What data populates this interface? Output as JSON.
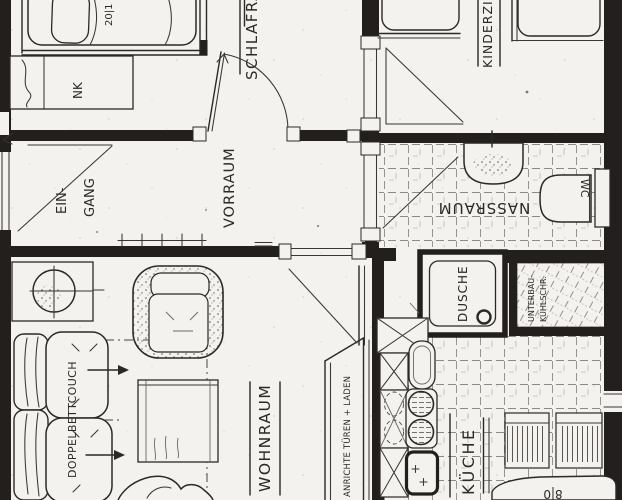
{
  "plan": {
    "rooms": {
      "schlafraum": "SCHLAFRAUM",
      "kinderzimmer": "KINDERZIM.",
      "vorraum": "VORRAUM",
      "eingang_line1": "EIN-",
      "eingang_line2": "GANG",
      "nassraum": "NASSRAUM",
      "wc": "WC",
      "dusche": "DUSCHE",
      "wohnraum": "WOHNRAUM",
      "kueche": "KÜCHE"
    },
    "furniture": {
      "nachtkaestchen": "NK",
      "doppelbettcouch": "DOPPELBETTCOUCH",
      "anrichte": "ANRICHTE TÜREN + LADEN",
      "kuehlschrank_line1": "UNTERBAU-",
      "kuehlschrank_line2": "KÜHLSCHR.",
      "bett_mass_fragment": "20|1",
      "tisch_fragment": "8|0"
    },
    "colors": {
      "paper": "#f4f2ef",
      "ink": "#2b2926",
      "tile_line": "#8d8a82"
    }
  }
}
